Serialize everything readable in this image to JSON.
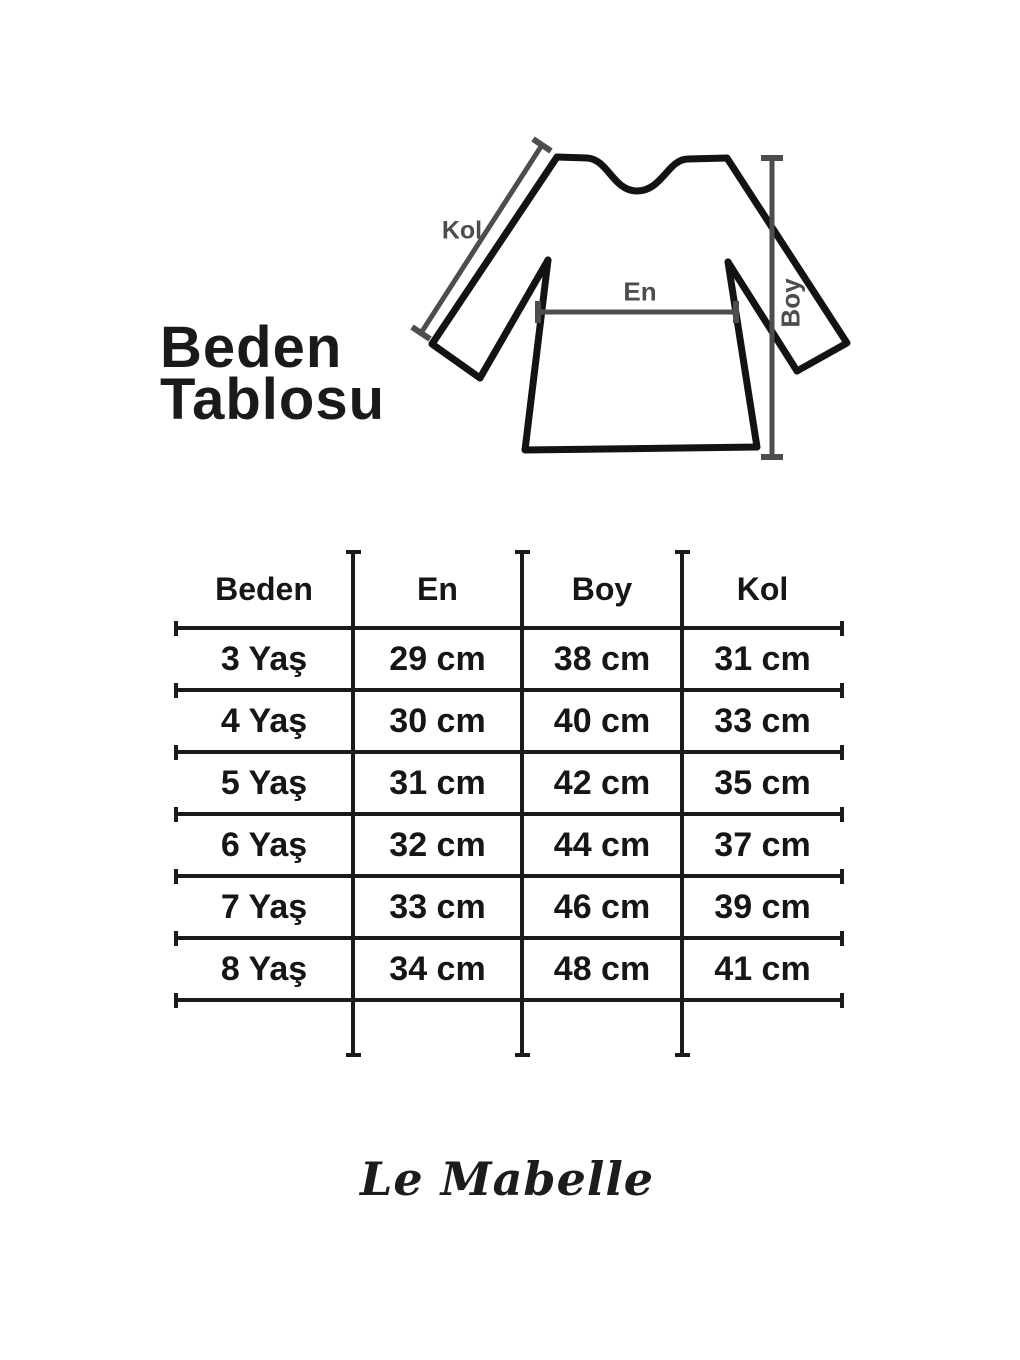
{
  "page": {
    "title_line1": "Beden",
    "title_line2": "Tablosu",
    "brand": "Le Mabelle"
  },
  "diagram": {
    "labels": {
      "kol": "Kol",
      "en": "En",
      "boy": "Boy"
    }
  },
  "size_table": {
    "headers": [
      "Beden",
      "En",
      "Boy",
      "Kol"
    ],
    "rows": [
      {
        "beden": "3 Yaş",
        "en": "29 cm",
        "boy": "38 cm",
        "kol": "31 cm"
      },
      {
        "beden": "4 Yaş",
        "en": "30 cm",
        "boy": "40 cm",
        "kol": "33 cm"
      },
      {
        "beden": "5 Yaş",
        "en": "31 cm",
        "boy": "42 cm",
        "kol": "35 cm"
      },
      {
        "beden": "6 Yaş",
        "en": "32 cm",
        "boy": "44 cm",
        "kol": "37 cm"
      },
      {
        "beden": "7 Yaş",
        "en": "33 cm",
        "boy": "46 cm",
        "kol": "39 cm"
      },
      {
        "beden": "8 Yaş",
        "en": "34 cm",
        "boy": "48 cm",
        "kol": "41 cm"
      }
    ]
  },
  "chart_data": {
    "type": "table",
    "title": "Beden Tablosu",
    "columns": [
      "Beden",
      "En",
      "Boy",
      "Kol"
    ],
    "rows": [
      [
        "3 Yaş",
        "29 cm",
        "38 cm",
        "31 cm"
      ],
      [
        "4 Yaş",
        "30 cm",
        "40 cm",
        "33 cm"
      ],
      [
        "5 Yaş",
        "31 cm",
        "42 cm",
        "35 cm"
      ],
      [
        "6 Yaş",
        "32 cm",
        "44 cm",
        "37 cm"
      ],
      [
        "7 Yaş",
        "33 cm",
        "46 cm",
        "39 cm"
      ],
      [
        "8 Yaş",
        "34 cm",
        "48 cm",
        "41 cm"
      ]
    ]
  },
  "colors": {
    "ink": "#1b1b1b",
    "measure_gray": "#4d4d4d",
    "background": "#ffffff"
  }
}
